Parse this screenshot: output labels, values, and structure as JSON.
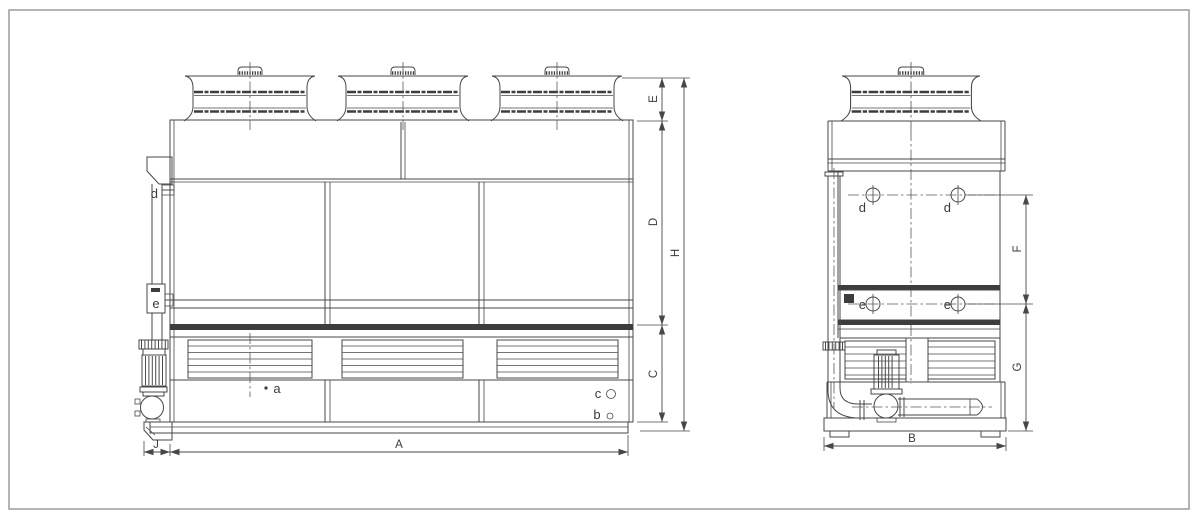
{
  "drawing": {
    "type": "technical-drawing",
    "subject": "closed circuit cooling tower - front and side elevations",
    "colors": {
      "line": "#474747",
      "dark_band": "#3d3d3d",
      "frame": "#9b9b9b",
      "background": "#ffffff"
    }
  },
  "front_view": {
    "dims": {
      "A": "A",
      "C": "C",
      "D": "D",
      "E": "E",
      "H": "H",
      "J": "J"
    },
    "labels": {
      "a": "a",
      "b": "b",
      "c": "c",
      "d": "d",
      "e": "e"
    }
  },
  "side_view": {
    "dims": {
      "B": "B",
      "F": "F",
      "G": "G"
    },
    "labels": {
      "d1": "d",
      "d2": "d",
      "e1": "e",
      "e2": "e"
    }
  }
}
